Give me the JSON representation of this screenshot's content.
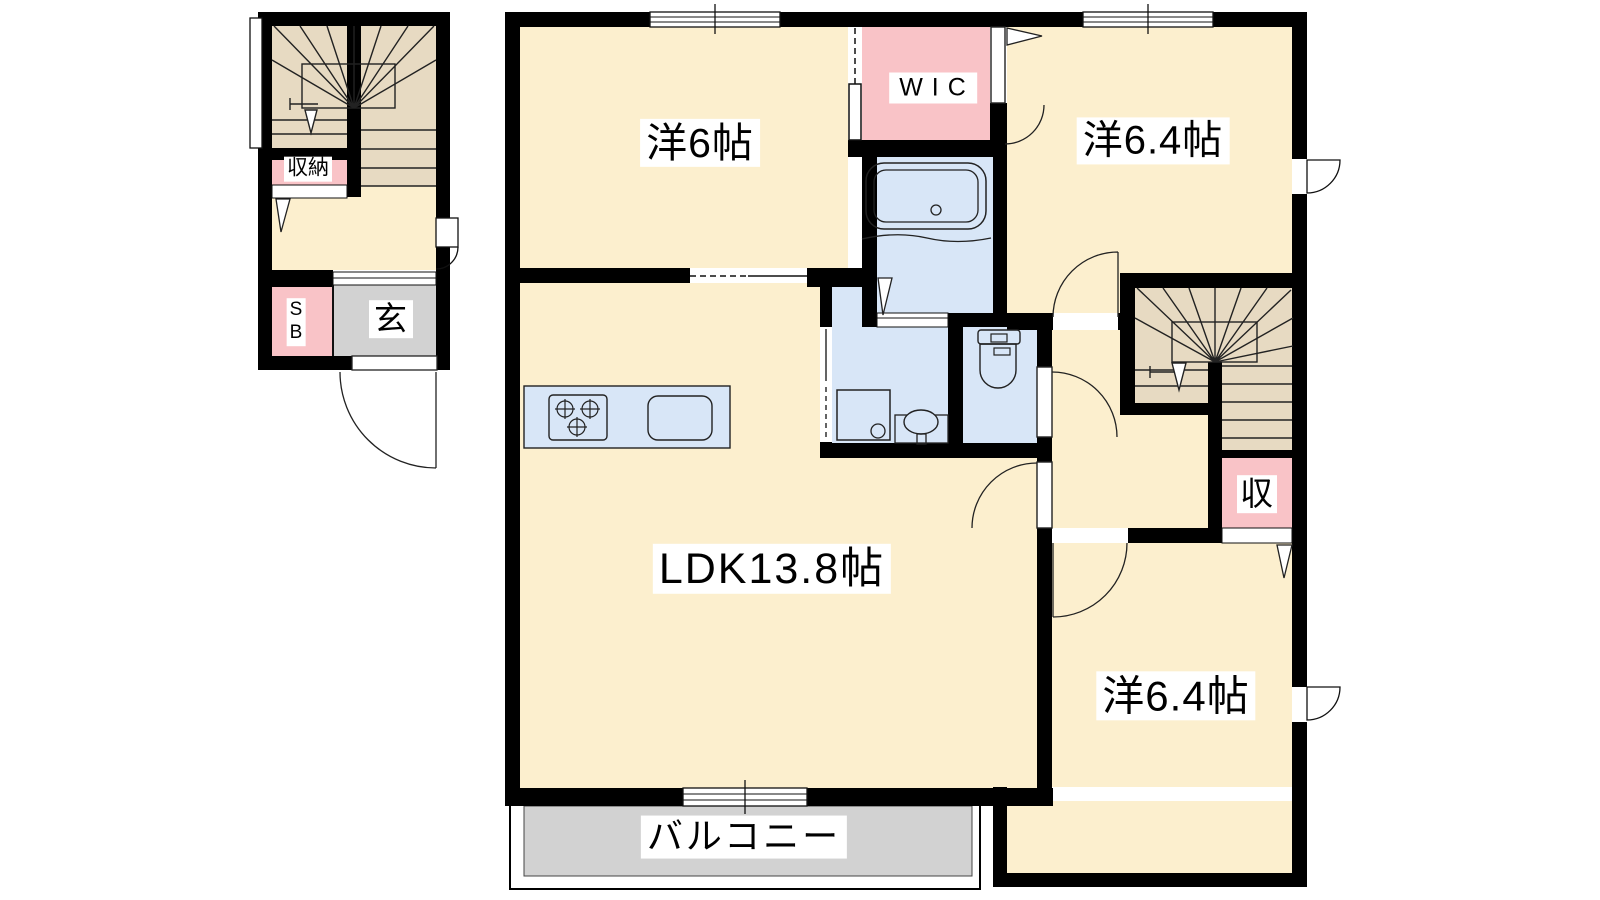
{
  "title": "apartment-floor-plan",
  "colors": {
    "room_floor": "#FCEFCE",
    "stairs": "#E7DAC2",
    "closet_pink": "#F9C3C7",
    "wet_area_blue": "#D8E6F7",
    "balcony_gray": "#D2D2D2",
    "wall": "#000000"
  },
  "floor2": {
    "bedroom1_label": "洋6帖",
    "wic_label": "WIC",
    "bedroom2_label": "洋6.4帖",
    "ldk_label": "LDK13.8帖",
    "bedroom3_label": "洋6.4帖",
    "balcony_label": "バルコニー",
    "closet_label": "収"
  },
  "floor1": {
    "closet_label": "収納",
    "shoe_box_label": "S\nB",
    "entrance_label": "玄"
  }
}
